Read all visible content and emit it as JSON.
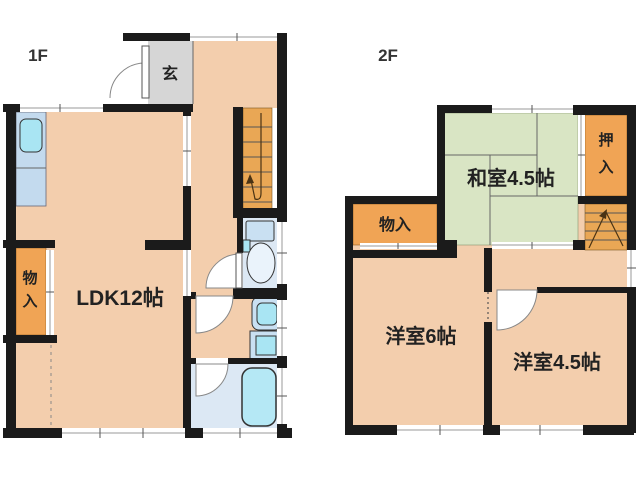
{
  "palette": {
    "wall": "#1b1b1b",
    "floor": "#f3cead",
    "genkan": "#d6d6d6",
    "closet": "#f0a455",
    "stairs": "#e9a755",
    "tatami": "#d9e5c4",
    "wet": "#dce8f4",
    "counter": "#c3daee",
    "fixture": "#c9e0f2",
    "basin": "#a9e5f3",
    "tub": "#b5e8f5",
    "line": "#555555",
    "winline": "#9a9a9a",
    "text": "#222222"
  },
  "floor1": {
    "label": "1F",
    "rooms": {
      "genkan": "玄",
      "ldk": "LDK12帖",
      "storage_char1": "物",
      "storage_char2": "入"
    }
  },
  "floor2": {
    "label": "2F",
    "rooms": {
      "washitsu": "和室4.5帖",
      "oshiire_char1": "押",
      "oshiire_char2": "入",
      "storage": "物入",
      "yoshitsu6": "洋室6帖",
      "yoshitsu45": "洋室4.5帖"
    }
  }
}
